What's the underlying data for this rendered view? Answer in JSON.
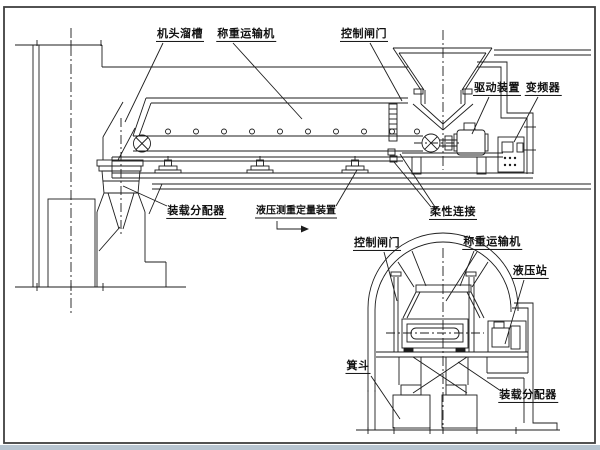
{
  "figure": {
    "type": "engineering-diagram",
    "description_views": [
      "side-elevation",
      "tunnel-cross-section"
    ],
    "colors": {
      "line": "#1c1c1c",
      "border": "#3f3f3f",
      "bottom_band": "#b7c5d1",
      "paper": "#ffffff"
    }
  },
  "labels": {
    "head_chute": "机头溜槽",
    "weighing_conveyor_top": "称重运输机",
    "control_gate_top": "控制闸门",
    "drive_unit": "驱动装置",
    "frequency_converter": "变频器",
    "loading_distributor_top": "装载分配器",
    "hydraulic_weighing_device": "液压测重定量装置",
    "flexible_connection": "柔性连接",
    "control_gate_bottom": "控制闸门",
    "weighing_conveyor_bottom": "称重运输机",
    "hydraulic_station": "液压站",
    "skip_bucket": "箕斗",
    "loading_distributor_bottom": "装载分配器"
  }
}
